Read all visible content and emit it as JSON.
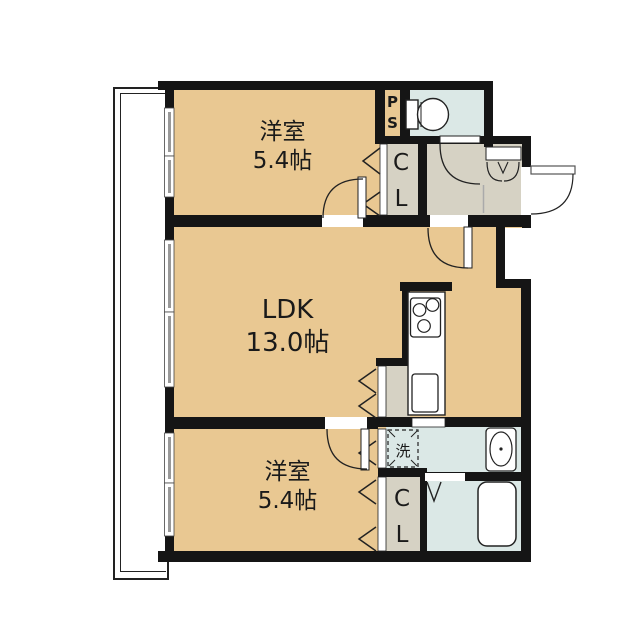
{
  "plan": {
    "rooms": {
      "western_top": {
        "name": "洋室",
        "size": "5.4帖"
      },
      "ldk": {
        "name": "LDK",
        "size": "13.0帖"
      },
      "western_bottom": {
        "name": "洋室",
        "size": "5.4帖"
      }
    },
    "labels": {
      "closet_top": {
        "l1": "C",
        "l2": "L"
      },
      "closet_bottom": {
        "l1": "C",
        "l2": "L"
      },
      "pipe_space": {
        "l1": "P",
        "l2": "S"
      },
      "laundry": "洗"
    },
    "colors": {
      "room_floor": "#e9c892",
      "hall_floor": "#d6d2c4",
      "wet_area": "#dbe8e6",
      "wall": "#151515",
      "background": "#ffffff"
    }
  }
}
